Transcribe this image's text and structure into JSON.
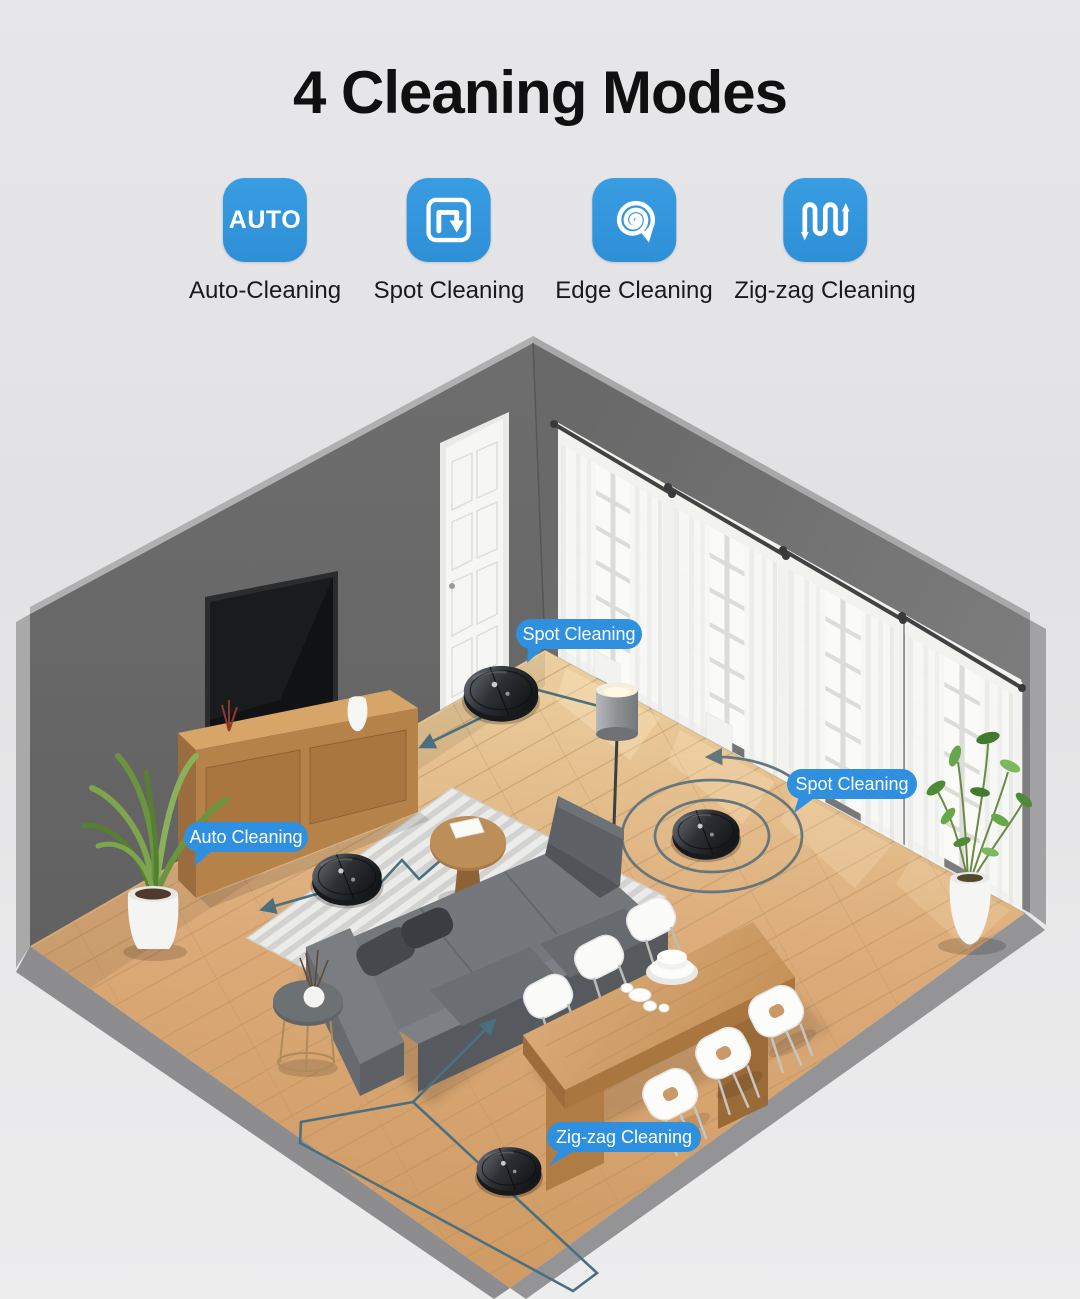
{
  "header": {
    "title": "4 Cleaning Modes"
  },
  "modes": [
    {
      "label": "Auto-Cleaning",
      "badge": "AUTO",
      "icon": "auto-badge-icon"
    },
    {
      "label": "Spot Cleaning",
      "icon": "loop-square-icon"
    },
    {
      "label": "Edge Cleaning",
      "icon": "spiral-icon"
    },
    {
      "label": "Zig-zag Cleaning",
      "icon": "zigzag-icon"
    }
  ],
  "scene_labels": {
    "spot_top": "Spot Cleaning",
    "auto_left": "Auto Cleaning",
    "spot_right": "Spot Cleaning",
    "zigzag_bottom": "Zig-zag Cleaning"
  },
  "colors": {
    "accent_blue": "#3095db",
    "label_blue": "#2e90de",
    "path_teal": "#4a7080",
    "wall_left": "#686868",
    "wall_right": "#787878",
    "floor_wood": "#d8a672",
    "background": "#e4e4e6"
  }
}
